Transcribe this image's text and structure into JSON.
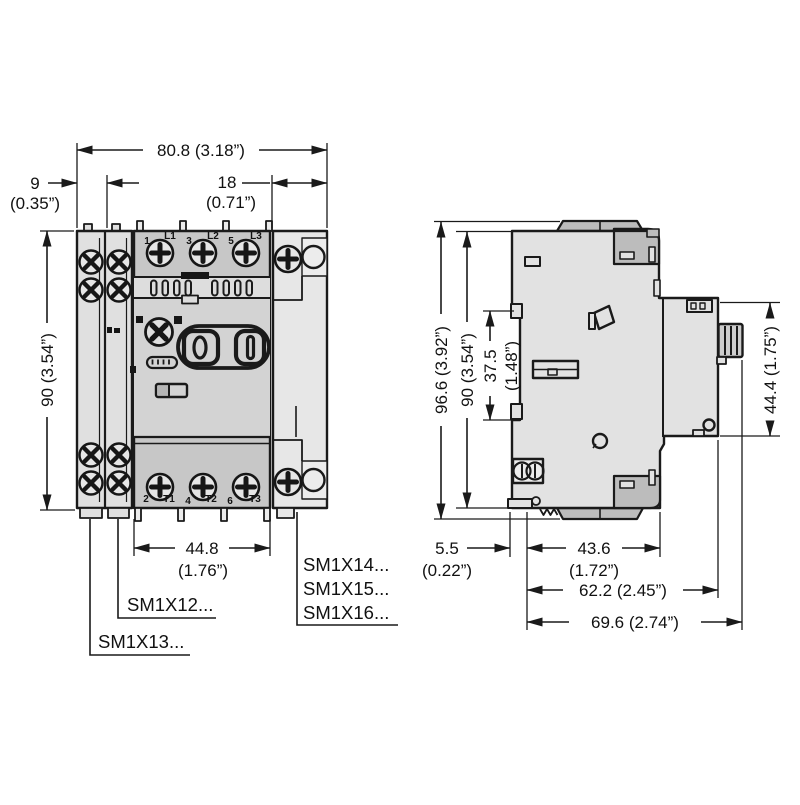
{
  "title": "SM1X motor protection circuit breaker — dimensional drawing",
  "colors": {
    "line": "#1a1a1a",
    "body_light": "#e2e2e2",
    "body_mid": "#d3d3d3",
    "strip": "#c7c7c7",
    "cap_dark": "#bcbcbc",
    "background": "#ffffff"
  },
  "front_view": {
    "dim_width": "80.8 (3.18”)",
    "dim_aux_width": "9",
    "dim_aux_width_in": "(0.35”)",
    "dim_right_width": "18",
    "dim_right_width_in": "(0.71”)",
    "dim_height": "90 (3.54”)",
    "dim_terminal_span": "44.8",
    "dim_terminal_span_in": "(1.76”)",
    "terminal_labels_top": [
      "1",
      "L1",
      "3",
      "L2",
      "5",
      "L3"
    ],
    "terminal_labels_bottom": [
      "2",
      "T1",
      "4",
      "T2",
      "6",
      "T3"
    ],
    "model_labels": {
      "sm1x12": "SM1X12...",
      "sm1x13": "SM1X13...",
      "sm1x14": "SM1X14...",
      "sm1x15": "SM1X15...",
      "sm1x16": "SM1X16..."
    }
  },
  "side_view": {
    "dim_height_overall": "96.6 (3.92”)",
    "dim_height_body": "90 (3.54”)",
    "dim_din_offset": "37.5",
    "dim_din_offset_in": "(1.48”)",
    "dim_front_height": "44.4 (1.75”)",
    "dim_back_depth": "5.5",
    "dim_back_depth_in": "(0.22”)",
    "dim_body_depth": "43.6",
    "dim_body_depth_in": "(1.72”)",
    "dim_depth_to_face": "62.2 (2.45”)",
    "dim_depth_overall": "69.6 (2.74”)"
  }
}
